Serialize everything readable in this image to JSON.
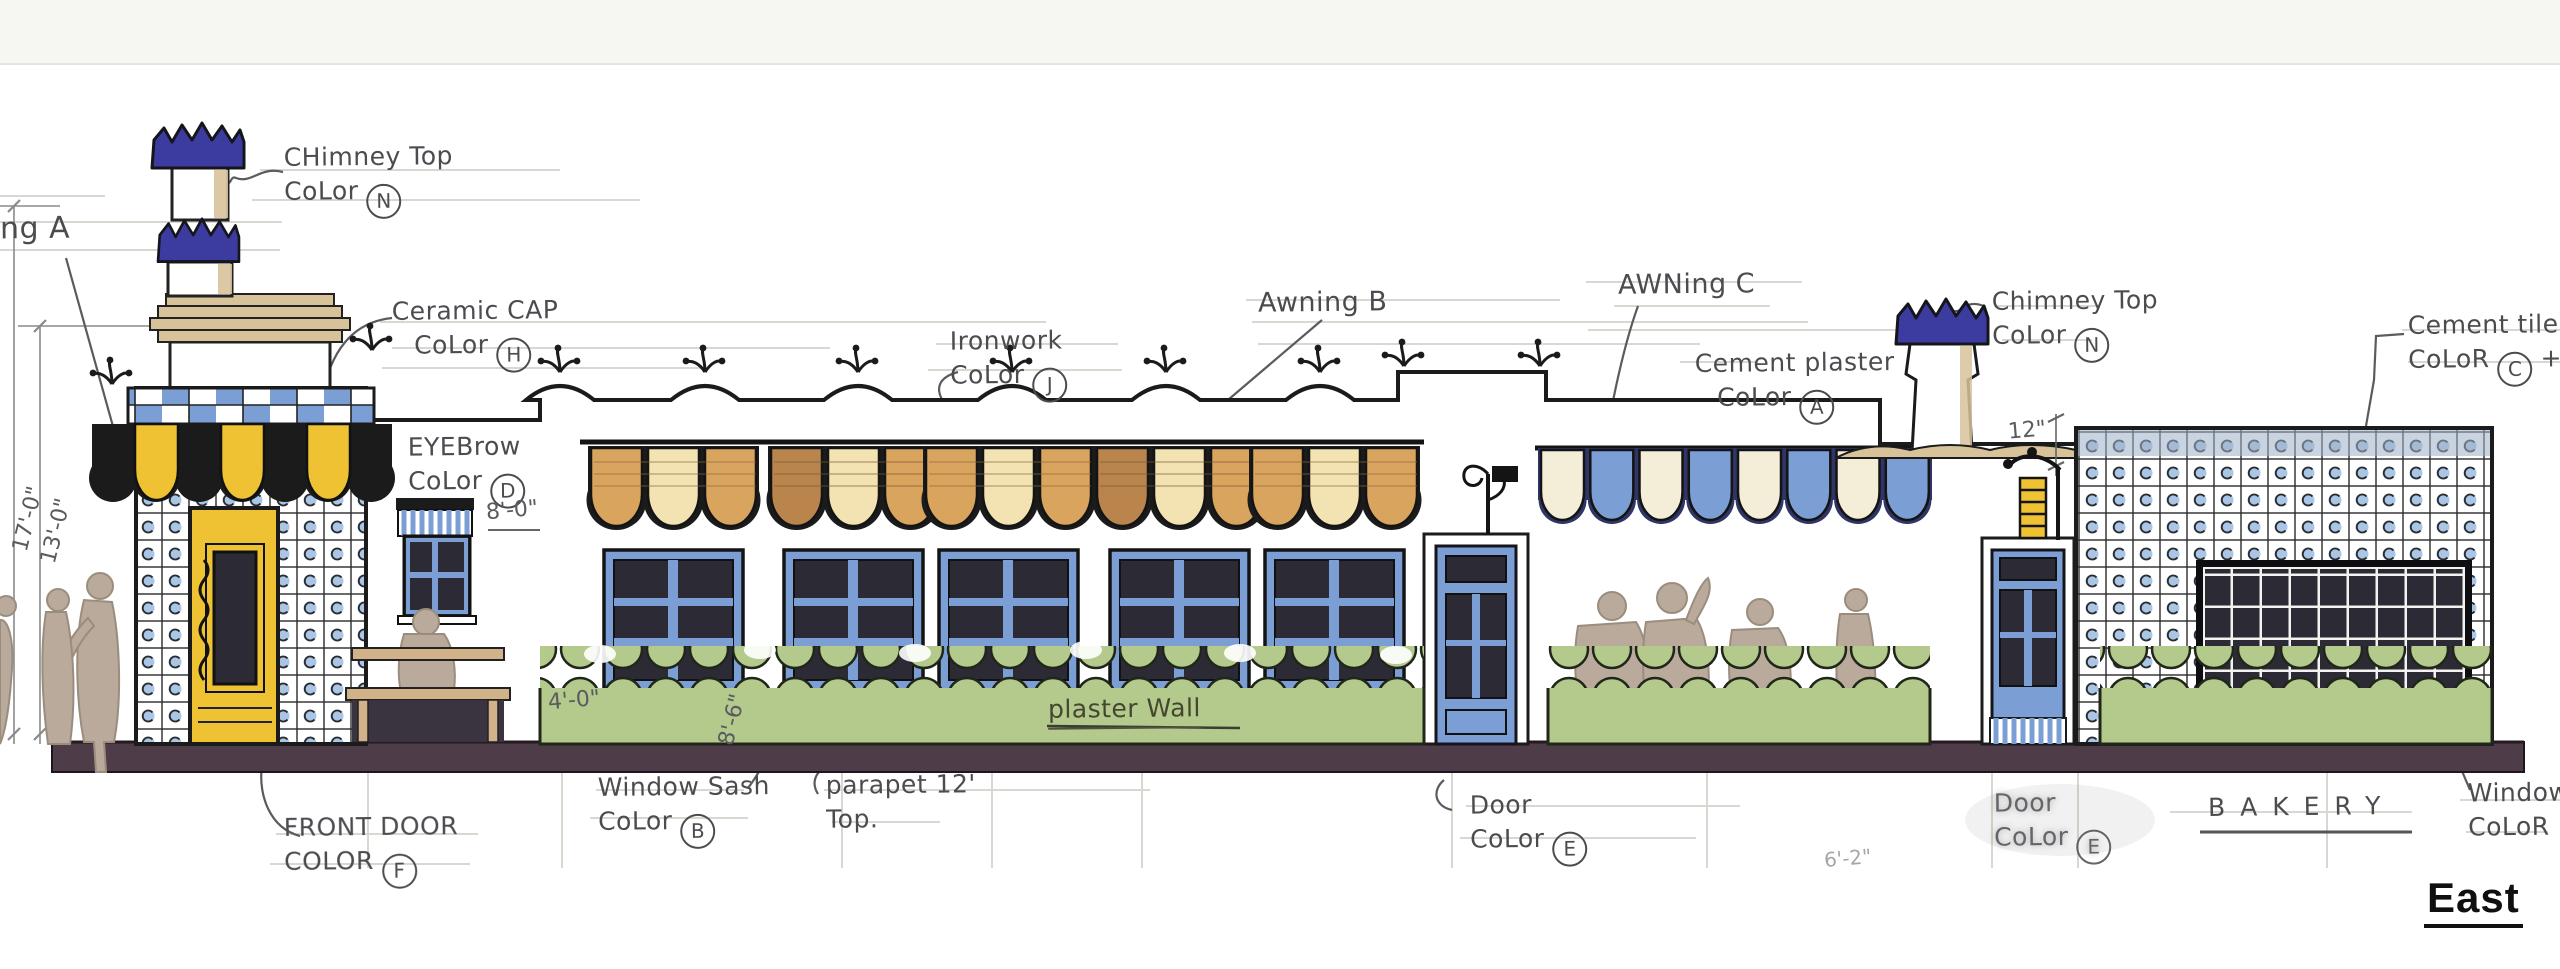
{
  "title": {
    "elevation_label": "East"
  },
  "building_name": "BAKERY",
  "annotations": [
    {
      "id": "awning-a-partial",
      "line1": "ng A"
    },
    {
      "id": "chimney-top-left",
      "line1": "CHimney Top",
      "line2": "CoLor",
      "letter": "N"
    },
    {
      "id": "ceramic-cap",
      "line1": "Ceramic CAP",
      "line2": "CoLor",
      "letter": "H"
    },
    {
      "id": "eyebrow",
      "line1": "EYEBrow",
      "line2": "CoLor",
      "letter": "D"
    },
    {
      "id": "ironwork",
      "line1": "Ironwork",
      "line2": "CoLor",
      "letter": "J"
    },
    {
      "id": "awning-b",
      "line1": "Awning B"
    },
    {
      "id": "awning-c",
      "line1": "AWNing C"
    },
    {
      "id": "cement-plaster",
      "line1": "Cement plaster",
      "line2": "CoLor",
      "letter": "A"
    },
    {
      "id": "chimney-top-right",
      "line1": "Chimney Top",
      "line2": "CoLor",
      "letter": "N"
    },
    {
      "id": "cement-tile",
      "line1": "Cement tile",
      "line2": "CoLoR",
      "letter": "C",
      "suffix": "+ ("
    },
    {
      "id": "window-sash",
      "line1": "Window Sash",
      "line2": "CoLor",
      "letter": "B"
    },
    {
      "id": "parapet-top",
      "line1": "parapet 12'",
      "line2": "Top."
    },
    {
      "id": "plaster-wall",
      "line1": "plaster Wall"
    },
    {
      "id": "door-color-mid",
      "line1": "Door",
      "line2": "CoLor",
      "letter": "E"
    },
    {
      "id": "front-door",
      "line1": "FRONT DOOR",
      "line2": "COLOR",
      "letter": "F"
    },
    {
      "id": "door-color-right",
      "line1": "Door",
      "line2": "CoLor",
      "letter": "E"
    },
    {
      "id": "bakery-sign",
      "line1": "BAKERY"
    },
    {
      "id": "window-color-right",
      "line1": "Window",
      "line2": "CoLoR ("
    }
  ],
  "dimensions": [
    {
      "id": "tower-height",
      "text": "17'-0\""
    },
    {
      "id": "parapet-height",
      "text": "13'-0\""
    },
    {
      "id": "eyebrow-height",
      "text": "8'-0\""
    },
    {
      "id": "hedge-height",
      "text": "4'-0\""
    },
    {
      "id": "wall-height",
      "text": "8'-6\""
    },
    {
      "id": "parapet-cap",
      "text": "12\""
    },
    {
      "id": "door-width",
      "text": "6'-2\""
    }
  ],
  "palette": {
    "paper": "#ffffff",
    "topband": "#f6f6f3",
    "ink": "#1b1b1b",
    "pencil": "#5a5b5f",
    "pencil_light": "#d6d3cb",
    "tile_blue": "#7b9fd4",
    "tile_dot": "#aac6e6",
    "crown_blue": "#3c3ca0",
    "navy": "#2f3566",
    "door_yellow": "#eec233",
    "awning_cream": "#f3e3b2",
    "awning_tan": "#d9a45e",
    "awning_brown": "#b9854d",
    "awning_c_cream": "#f4edd8",
    "hedge_green": "#b3ca8c",
    "ground_brown": "#4e3c48",
    "figure_tan": "#b9aa9b",
    "figure_edge": "#9b8d7e",
    "pane_dark": "#2c2a35",
    "trim_tan": "#d8c29a",
    "bench_tan": "#d2b289"
  }
}
